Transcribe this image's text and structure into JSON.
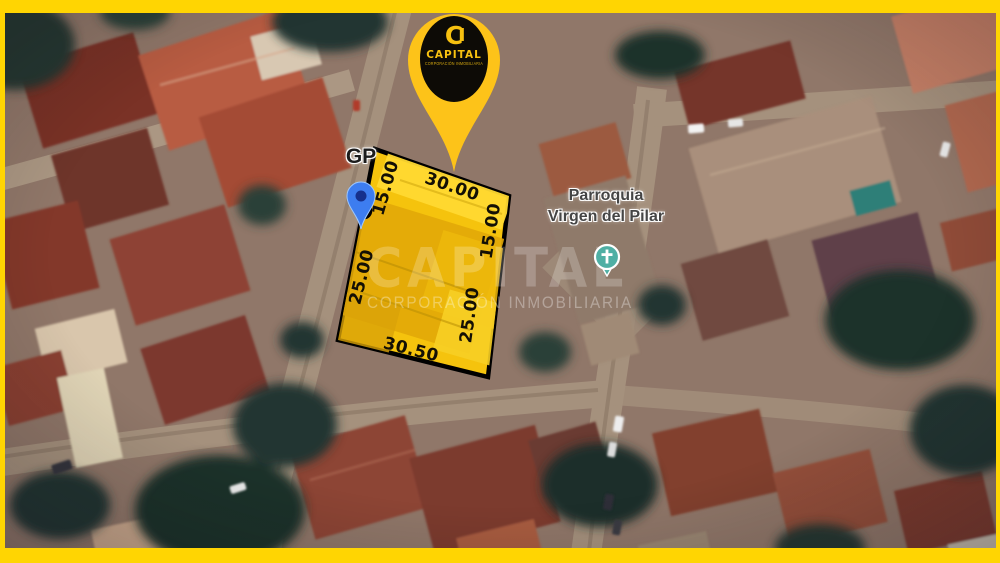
{
  "frame": {
    "color": "#ffd502"
  },
  "pin": {
    "logo_letter": "C",
    "brand": "CAPITAL",
    "brand_subtitle": "CORPORACIÓN INMOBILIARIA",
    "color": "#fdc319"
  },
  "map_labels": {
    "gp": "GP",
    "church_line1": "Parroquia",
    "church_line2": "Virgen del Pilar"
  },
  "church_icon": {
    "color": "#4fafa4"
  },
  "lot": {
    "fill": "#f5c30d",
    "border": "#000000",
    "measurements": {
      "top": "30.00",
      "left_upper": "15.00",
      "left_lower": "25.00",
      "right_upper": "15.00",
      "right_lower": "25.00",
      "bottom": "30.50"
    }
  },
  "watermark": {
    "title": "CAPITAL",
    "subtitle": "CORPORACIÓN INMOBILIARIA"
  }
}
